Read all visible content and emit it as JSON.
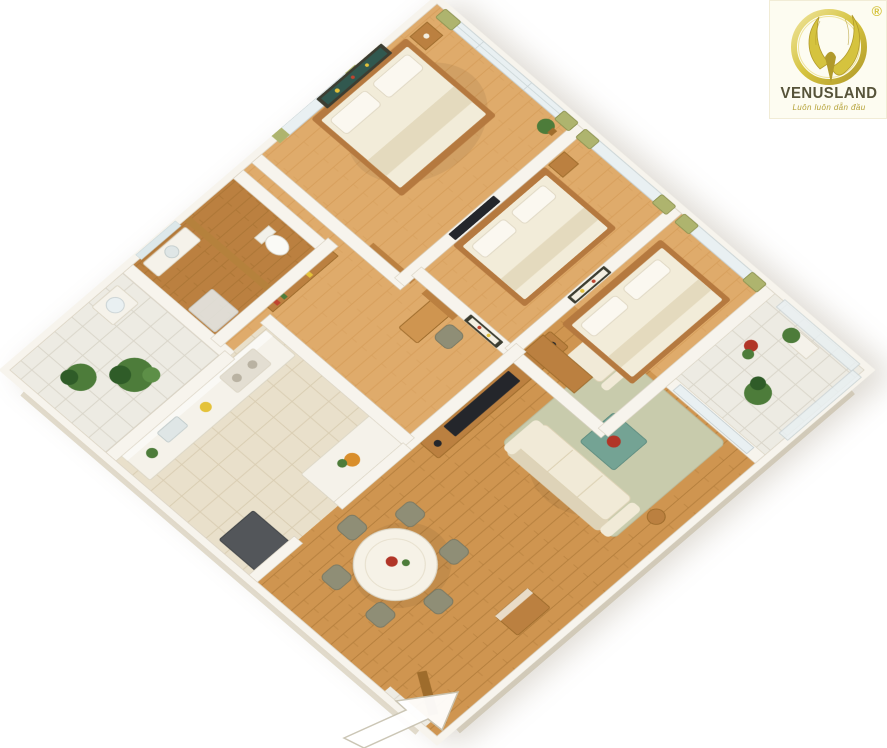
{
  "meta": {
    "width": 887,
    "height": 748,
    "background": "#ffffff",
    "scene": "isometric-3d-apartment-floor-plan"
  },
  "logo": {
    "brand": "VENUSLAND",
    "tagline": "Luôn luôn dẫn đầu",
    "registered_mark": "®"
  },
  "logo_colors": {
    "box_bg": "#fdfcf1",
    "gold": "#d5c33e",
    "gold_dark": "#b19a2b",
    "gold_light": "#efe49c",
    "text": "#565339",
    "tagline_text": "#b5a238"
  },
  "palette": {
    "wall": "#f7f4ed",
    "wall_edge": "#d9d2c2",
    "wall_face_light": "#fcfbf7",
    "wall_face_dark": "#e5dfd0",
    "wall_face_shade": "#f0eadb",
    "wood_light": "#dfab6b",
    "wood": "#cf9550",
    "wood_dark": "#bb8040",
    "wood_deep": "#9e6c2c",
    "wood_wall": "#b5813c",
    "tile": "#edebe3",
    "tile_line": "#d9d5c9",
    "tile_warm": "#e9e0cb",
    "tile_warm_line": "#d9cdb2",
    "glass": "#e9f0f2",
    "glass_frame": "#c9d2d4",
    "curtain": "#aeb46e",
    "rug": "#c8cbac",
    "sofa": "#f1ead7",
    "sofa_shade": "#ded3b8",
    "coffee": "#74a394",
    "bed": "#f2ecd9",
    "bed_fold": "#e4dabe",
    "pillow": "#fbf8f0",
    "bed_frame": "#b5793f",
    "table": "#f6f2e7",
    "chair": "#8f8e76",
    "chair_dark": "#7a7963",
    "counter": "#f5f2ea",
    "counter_edge": "#dcd6c6",
    "appliance": "#53565a",
    "tv": "#24262b",
    "plant": "#4d7c3a",
    "plant_dark": "#2f5c28",
    "flower": "#b13527",
    "art_frame": "#3c3d31",
    "art_teal": "#31584f",
    "art_yellow": "#e4c23a",
    "art_red": "#bf4430"
  },
  "rooms": [
    "balcony-left",
    "bathroom",
    "master-bedroom",
    "bedroom-2",
    "bedroom-3",
    "balcony-right",
    "living-room",
    "dining-area",
    "kitchen",
    "hallway-study",
    "entrance"
  ],
  "entrance_arrow": {
    "points_toward": "entrance-door"
  }
}
